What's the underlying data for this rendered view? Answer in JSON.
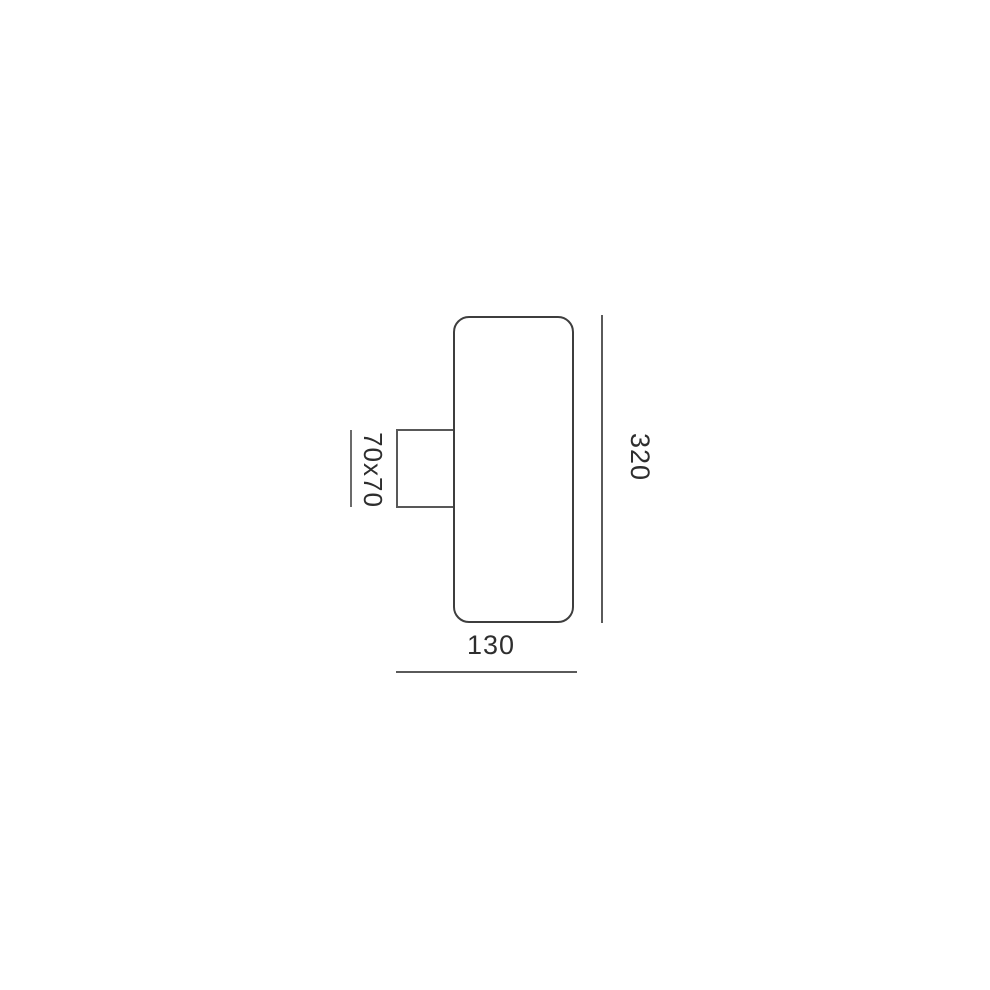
{
  "diagram": {
    "dimension_labels": {
      "height": "320",
      "width": "130",
      "bracket": "70x70"
    },
    "colors": {
      "background": "#ffffff",
      "body_outline": "#3e3e3e",
      "bracket_outline": "#585858",
      "dimension_line": "#5a5a5a",
      "text": "#2e2e2e"
    }
  }
}
